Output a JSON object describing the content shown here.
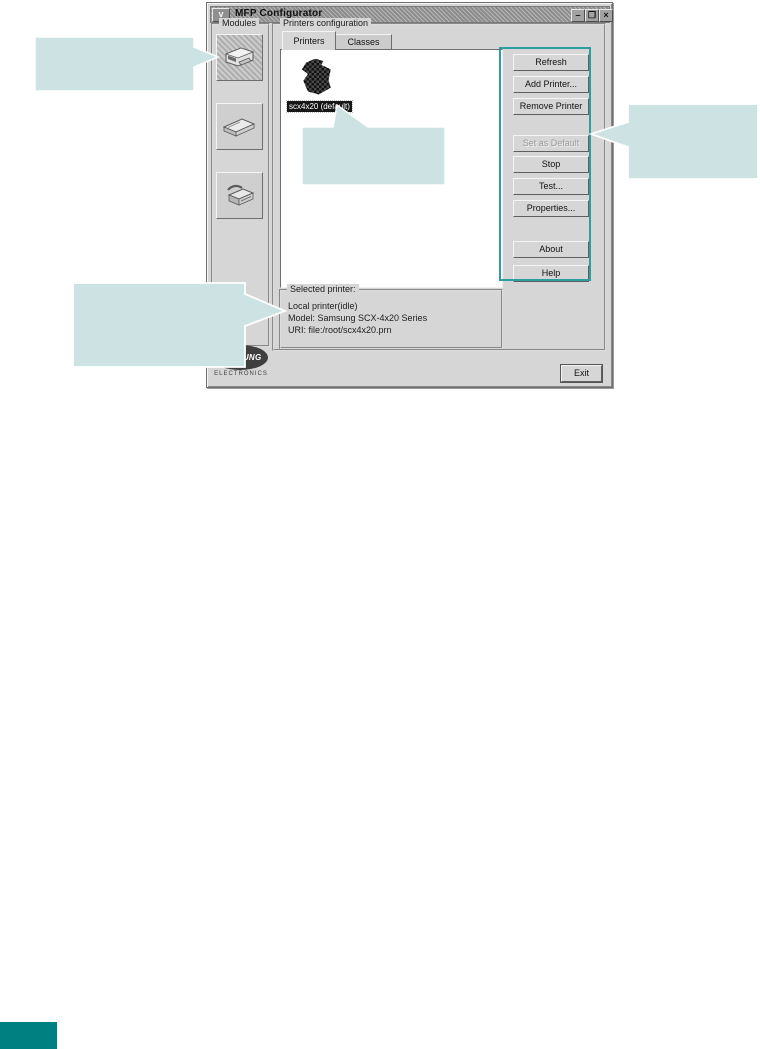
{
  "window": {
    "title": "MFP Configurator",
    "menu_glyph": "v",
    "minimize_glyph": "–",
    "maximize_glyph": "❐",
    "close_glyph": "×"
  },
  "modules": {
    "label": "Modules",
    "items": [
      {
        "name": "printer-module"
      },
      {
        "name": "scanner-module"
      },
      {
        "name": "fax-module"
      }
    ]
  },
  "printers_configuration": {
    "label": "Printers configuration",
    "tabs": [
      {
        "label": "Printers",
        "active": true
      },
      {
        "label": "Classes",
        "active": false
      }
    ],
    "printer_list": {
      "selected_item": "scx4x20 (default)"
    },
    "buttons": [
      {
        "label": "Refresh",
        "disabled": false
      },
      {
        "label": "Add Printer...",
        "disabled": false
      },
      {
        "label": "Remove Printer",
        "disabled": false
      },
      {
        "label": "Set as Default",
        "disabled": true
      },
      {
        "label": "Stop",
        "disabled": false
      },
      {
        "label": "Test...",
        "disabled": false
      },
      {
        "label": "Properties...",
        "disabled": false
      },
      {
        "label": "About",
        "disabled": false
      },
      {
        "label": "Help",
        "disabled": false
      }
    ],
    "selected_printer": {
      "label": "Selected printer:",
      "status": "Local printer(idle)",
      "model": "Model: Samsung SCX-4x20 Series",
      "uri": "URI: file:/root/scx4x20.prn"
    }
  },
  "footer": {
    "exit": "Exit"
  },
  "logo": {
    "brand": "SAMSUNG",
    "subtitle": "ELECTRONICS"
  },
  "colors": {
    "callout_fill": "#cde2e2",
    "highlight_outline": "#2b9e9e",
    "page_corner": "#008080"
  }
}
